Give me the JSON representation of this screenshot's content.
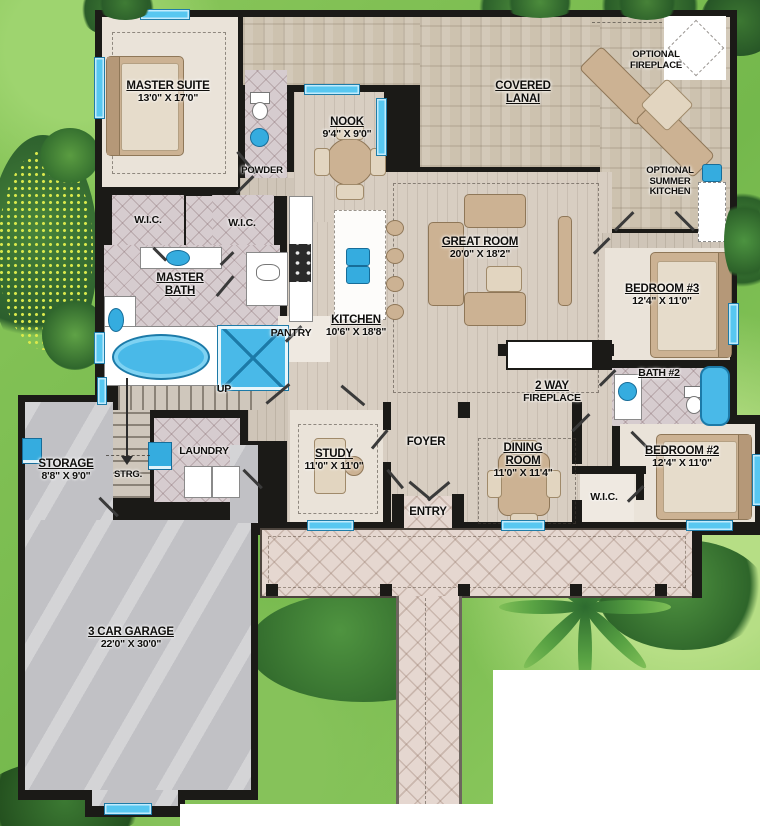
{
  "plan_title": "floor-plan",
  "colors": {
    "wall": "#1b1a17",
    "window": "#57c7f0",
    "fixture_blue": "#35acdf",
    "grass": "#7dbf52",
    "wood_floor": "#d8cec2",
    "tile_floor": "#d6cccf",
    "lanai_floor": "#cdc2af",
    "porch_floor": "#e5d7d0",
    "garage_floor": "#c1c1c5",
    "carpet": "#eae3d9",
    "furniture": "#ccb293",
    "label_text": "#0f0e0c"
  },
  "rooms": {
    "master_suite": {
      "name": "MASTER SUITE",
      "dims": "13'0\" X 17'0\""
    },
    "powder": {
      "name": "POWDER"
    },
    "nook": {
      "name": "NOOK",
      "dims": "9'4\" X 9'0\""
    },
    "covered_lanai": {
      "name": "COVERED LANAI"
    },
    "optional_fireplace": {
      "name": "OPTIONAL FIREPLACE"
    },
    "optional_summer_kitchen": {
      "name": "OPTIONAL SUMMER KITCHEN"
    },
    "wic_master_left": {
      "name": "W.I.C."
    },
    "wic_master_right": {
      "name": "W.I.C."
    },
    "master_bath": {
      "name": "MASTER BATH"
    },
    "pantry": {
      "name": "PANTRY"
    },
    "kitchen": {
      "name": "KITCHEN",
      "dims": "10'6\" X 18'8\""
    },
    "great_room": {
      "name": "GREAT ROOM",
      "dims": "20'0\" X 18'2\""
    },
    "bedroom_3": {
      "name": "BEDROOM #3",
      "dims": "12'4\" X 11'0\""
    },
    "bath_2": {
      "name": "BATH #2"
    },
    "two_way_fireplace": {
      "line1": "2 WAY",
      "line2": "FIREPLACE"
    },
    "bedroom_2": {
      "name": "BEDROOM #2",
      "dims": "12'4\" X 11'0\""
    },
    "wic_bedroom_2": {
      "name": "W.I.C."
    },
    "dining_room": {
      "name": "DINING ROOM",
      "dims": "11'0\" X 11'4\""
    },
    "foyer": {
      "name": "FOYER"
    },
    "entry": {
      "name": "ENTRY"
    },
    "study": {
      "name": "STUDY",
      "dims": "11'0\" X 11'0\""
    },
    "laundry": {
      "name": "LAUNDRY"
    },
    "storage": {
      "name": "STORAGE",
      "dims": "8'8\" X 9'0\""
    },
    "strg": {
      "name": "STRG."
    },
    "stairs": {
      "name": "UP"
    },
    "garage": {
      "name": "3 CAR GARAGE",
      "dims": "22'0\" X 30'0\""
    }
  }
}
